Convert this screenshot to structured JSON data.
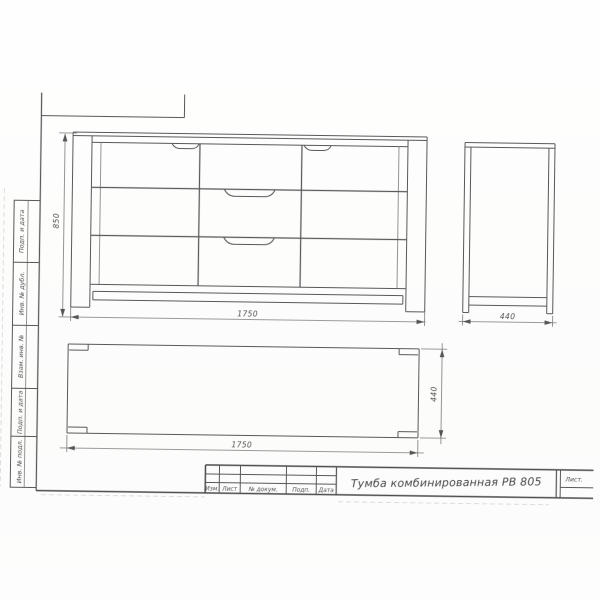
{
  "drawing": {
    "dimensions": {
      "front_height": "850",
      "front_width": "1750",
      "side_depth": "440",
      "top_width": "1750",
      "top_depth": "440"
    },
    "title_block": {
      "title": "Тумба комбинированная РВ 805",
      "col_izm": "Изм.",
      "col_list": "Лист",
      "col_dokum": "№ докум.",
      "col_podp": "Подп.",
      "col_data": "Дата",
      "sheet_label": "Лист."
    },
    "side_stamps": {
      "s1": "Подп. и дата",
      "s2": "Инв. № дубл.",
      "s3": "Взам. инв. №",
      "s4": "Подп. и дата",
      "s5": "Инв. № подл."
    }
  }
}
